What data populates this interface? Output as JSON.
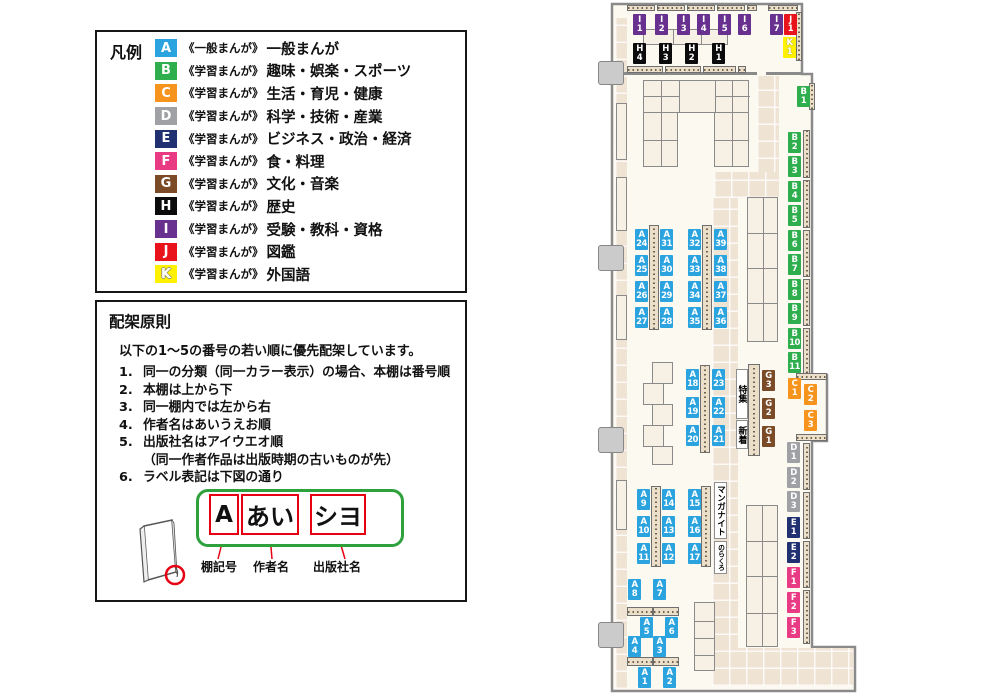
{
  "legend": {
    "title": "凡例",
    "items": [
      {
        "code": "A",
        "series": "《一般まんが》",
        "category": "一般まんが"
      },
      {
        "code": "B",
        "series": "《学習まんが》",
        "category": "趣味・娯楽・スポーツ"
      },
      {
        "code": "C",
        "series": "《学習まんが》",
        "category": "生活・育児・健康"
      },
      {
        "code": "D",
        "series": "《学習まんが》",
        "category": "科学・技術・産業"
      },
      {
        "code": "E",
        "series": "《学習まんが》",
        "category": "ビジネス・政治・経済"
      },
      {
        "code": "F",
        "series": "《学習まんが》",
        "category": "食・料理"
      },
      {
        "code": "G",
        "series": "《学習まんが》",
        "category": "文化・音楽"
      },
      {
        "code": "H",
        "series": "《学習まんが》",
        "category": "歴史"
      },
      {
        "code": "I",
        "series": "《学習まんが》",
        "category": "受験・教科・資格"
      },
      {
        "code": "J",
        "series": "《学習まんが》",
        "category": "図鑑"
      },
      {
        "code": "K",
        "series": "《学習まんが》",
        "category": "外国語"
      }
    ]
  },
  "principles": {
    "title": "配架原則",
    "intro": "以下の1～5の番号の若い順に優先配架しています。",
    "rules": [
      {
        "num": "1.",
        "lines": [
          "同一の分類（同一カラー表示）の場合、本棚は番号順"
        ]
      },
      {
        "num": "2.",
        "lines": [
          "本棚は上から下"
        ]
      },
      {
        "num": "3.",
        "lines": [
          "同一棚内では左から右"
        ]
      },
      {
        "num": "4.",
        "lines": [
          "作者名はあいうえお順"
        ]
      },
      {
        "num": "5.",
        "lines": [
          "出版社名はアイウエオ順",
          "（同一作者作品は出版時期の古いものが先）"
        ]
      },
      {
        "num": "6.",
        "lines": [
          "ラベル表記は下図の通り"
        ]
      }
    ],
    "label_diagram": {
      "parts": [
        {
          "text": "A",
          "caption": "棚記号"
        },
        {
          "text": "あい",
          "caption": "作者名"
        },
        {
          "text": "シヨ",
          "caption": "出版社名"
        }
      ]
    }
  },
  "map": {
    "chip_colors": {
      "A": "#2AA3DF",
      "B": "#2FAE4D",
      "C": "#F7941E",
      "D": "#9FA1A4",
      "E": "#203070",
      "F": "#E93A84",
      "G": "#7A4B26",
      "H": "#0B0B0B",
      "I": "#68308F",
      "J": "#E8131B",
      "K": "#FFF100"
    },
    "chips": [
      {
        "c": "I",
        "n": "1",
        "x": 633,
        "y": 14
      },
      {
        "c": "I",
        "n": "2",
        "x": 655,
        "y": 14
      },
      {
        "c": "I",
        "n": "3",
        "x": 677,
        "y": 14
      },
      {
        "c": "I",
        "n": "4",
        "x": 697,
        "y": 14
      },
      {
        "c": "I",
        "n": "5",
        "x": 718,
        "y": 14
      },
      {
        "c": "I",
        "n": "6",
        "x": 738,
        "y": 14
      },
      {
        "c": "I",
        "n": "7",
        "x": 770,
        "y": 14
      },
      {
        "c": "J",
        "n": "1",
        "x": 784,
        "y": 14
      },
      {
        "c": "K",
        "n": "1",
        "x": 783,
        "y": 37
      },
      {
        "c": "H",
        "n": "4",
        "x": 633,
        "y": 43
      },
      {
        "c": "H",
        "n": "3",
        "x": 659,
        "y": 43
      },
      {
        "c": "H",
        "n": "2",
        "x": 685,
        "y": 43
      },
      {
        "c": "H",
        "n": "1",
        "x": 712,
        "y": 43
      },
      {
        "c": "B",
        "n": "1",
        "x": 797,
        "y": 86
      },
      {
        "c": "B",
        "n": "2",
        "x": 788,
        "y": 132
      },
      {
        "c": "B",
        "n": "3",
        "x": 788,
        "y": 156
      },
      {
        "c": "B",
        "n": "4",
        "x": 788,
        "y": 181
      },
      {
        "c": "B",
        "n": "5",
        "x": 788,
        "y": 205
      },
      {
        "c": "B",
        "n": "6",
        "x": 788,
        "y": 230
      },
      {
        "c": "B",
        "n": "7",
        "x": 788,
        "y": 254
      },
      {
        "c": "B",
        "n": "8",
        "x": 788,
        "y": 279
      },
      {
        "c": "B",
        "n": "9",
        "x": 788,
        "y": 303
      },
      {
        "c": "B",
        "n": "10",
        "x": 788,
        "y": 328
      },
      {
        "c": "B",
        "n": "11",
        "x": 788,
        "y": 352
      },
      {
        "c": "C",
        "n": "1",
        "x": 788,
        "y": 378
      },
      {
        "c": "C",
        "n": "2",
        "x": 804,
        "y": 384
      },
      {
        "c": "C",
        "n": "3",
        "x": 804,
        "y": 410
      },
      {
        "c": "D",
        "n": "1",
        "x": 787,
        "y": 442
      },
      {
        "c": "D",
        "n": "2",
        "x": 787,
        "y": 467
      },
      {
        "c": "D",
        "n": "3",
        "x": 787,
        "y": 491
      },
      {
        "c": "E",
        "n": "1",
        "x": 787,
        "y": 517
      },
      {
        "c": "E",
        "n": "2",
        "x": 787,
        "y": 542
      },
      {
        "c": "F",
        "n": "1",
        "x": 787,
        "y": 567
      },
      {
        "c": "F",
        "n": "2",
        "x": 787,
        "y": 592
      },
      {
        "c": "F",
        "n": "3",
        "x": 787,
        "y": 617
      },
      {
        "c": "G",
        "n": "3",
        "x": 762,
        "y": 370
      },
      {
        "c": "G",
        "n": "2",
        "x": 762,
        "y": 398
      },
      {
        "c": "G",
        "n": "1",
        "x": 762,
        "y": 426
      },
      {
        "c": "A",
        "n": "24",
        "x": 635,
        "y": 229
      },
      {
        "c": "A",
        "n": "31",
        "x": 660,
        "y": 229
      },
      {
        "c": "A",
        "n": "25",
        "x": 635,
        "y": 255
      },
      {
        "c": "A",
        "n": "30",
        "x": 660,
        "y": 255
      },
      {
        "c": "A",
        "n": "26",
        "x": 635,
        "y": 281
      },
      {
        "c": "A",
        "n": "29",
        "x": 660,
        "y": 281
      },
      {
        "c": "A",
        "n": "27",
        "x": 635,
        "y": 307
      },
      {
        "c": "A",
        "n": "28",
        "x": 660,
        "y": 307
      },
      {
        "c": "A",
        "n": "32",
        "x": 688,
        "y": 229
      },
      {
        "c": "A",
        "n": "39",
        "x": 714,
        "y": 229
      },
      {
        "c": "A",
        "n": "33",
        "x": 688,
        "y": 255
      },
      {
        "c": "A",
        "n": "38",
        "x": 714,
        "y": 255
      },
      {
        "c": "A",
        "n": "34",
        "x": 688,
        "y": 281
      },
      {
        "c": "A",
        "n": "37",
        "x": 714,
        "y": 281
      },
      {
        "c": "A",
        "n": "35",
        "x": 688,
        "y": 307
      },
      {
        "c": "A",
        "n": "36",
        "x": 714,
        "y": 307
      },
      {
        "c": "A",
        "n": "18",
        "x": 686,
        "y": 369
      },
      {
        "c": "A",
        "n": "23",
        "x": 712,
        "y": 369
      },
      {
        "c": "A",
        "n": "19",
        "x": 686,
        "y": 397
      },
      {
        "c": "A",
        "n": "22",
        "x": 712,
        "y": 397
      },
      {
        "c": "A",
        "n": "20",
        "x": 686,
        "y": 425
      },
      {
        "c": "A",
        "n": "21",
        "x": 712,
        "y": 425
      },
      {
        "c": "A",
        "n": "9",
        "x": 637,
        "y": 489
      },
      {
        "c": "A",
        "n": "14",
        "x": 662,
        "y": 489
      },
      {
        "c": "A",
        "n": "10",
        "x": 637,
        "y": 516
      },
      {
        "c": "A",
        "n": "13",
        "x": 662,
        "y": 516
      },
      {
        "c": "A",
        "n": "11",
        "x": 637,
        "y": 543
      },
      {
        "c": "A",
        "n": "12",
        "x": 662,
        "y": 543
      },
      {
        "c": "A",
        "n": "15",
        "x": 688,
        "y": 489
      },
      {
        "c": "A",
        "n": "16",
        "x": 688,
        "y": 516
      },
      {
        "c": "A",
        "n": "17",
        "x": 688,
        "y": 543
      },
      {
        "c": "A",
        "n": "8",
        "x": 628,
        "y": 579
      },
      {
        "c": "A",
        "n": "7",
        "x": 653,
        "y": 579
      },
      {
        "c": "A",
        "n": "5",
        "x": 640,
        "y": 617
      },
      {
        "c": "A",
        "n": "6",
        "x": 665,
        "y": 617
      },
      {
        "c": "A",
        "n": "4",
        "x": 628,
        "y": 636
      },
      {
        "c": "A",
        "n": "3",
        "x": 653,
        "y": 636
      },
      {
        "c": "A",
        "n": "1",
        "x": 638,
        "y": 667
      },
      {
        "c": "A",
        "n": "2",
        "x": 663,
        "y": 667
      }
    ],
    "area_labels": [
      {
        "text": "特集",
        "x": 736,
        "y": 369,
        "w": 12,
        "h": 50
      },
      {
        "text": "新着",
        "x": 736,
        "y": 420,
        "w": 12,
        "h": 29
      },
      {
        "text": "マンガナイト",
        "x": 714,
        "y": 482,
        "w": 13,
        "h": 57
      },
      {
        "text": "のらくろ",
        "x": 714,
        "y": 541,
        "w": 13,
        "h": 33
      }
    ]
  }
}
